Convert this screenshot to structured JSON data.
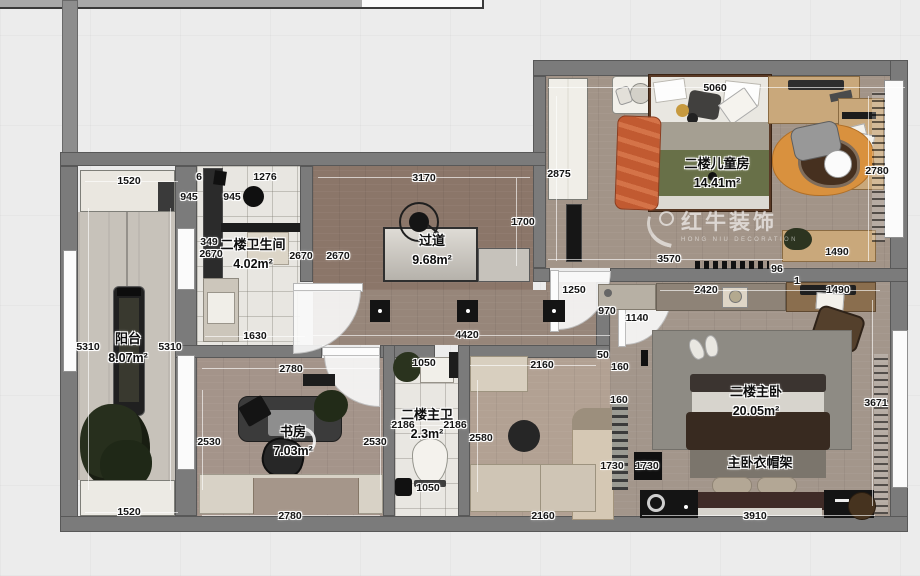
{
  "watermark": {
    "brand": "红牛装饰",
    "subtitle": "HONG NIU DECORATION"
  },
  "rooms": [
    {
      "name": "二楼儿童房",
      "area": "14.41m²",
      "x": 717,
      "y": 174
    },
    {
      "name": "过道",
      "area": "9.68m²",
      "x": 432,
      "y": 251
    },
    {
      "name": "二楼卫生间",
      "area": "4.02m²",
      "x": 253,
      "y": 255
    },
    {
      "name": "阳台",
      "area": "8.07m²",
      "x": 128,
      "y": 349
    },
    {
      "name": "书房",
      "area": "7.03m²",
      "x": 293,
      "y": 442
    },
    {
      "name": "二楼主卫",
      "area": "2.3m²",
      "x": 427,
      "y": 425
    },
    {
      "name": "二楼主卧",
      "area": "20.05m²",
      "x": 756,
      "y": 402
    },
    {
      "name": "主卧衣帽架",
      "area": "",
      "x": 760,
      "y": 463
    }
  ],
  "dimensions": [
    {
      "text": "5060",
      "x": 715,
      "y": 88
    },
    {
      "text": "2875",
      "x": 559,
      "y": 174
    },
    {
      "text": "2780",
      "x": 877,
      "y": 171
    },
    {
      "text": "3570",
      "x": 669,
      "y": 259
    },
    {
      "text": "96",
      "x": 777,
      "y": 269
    },
    {
      "text": "1490",
      "x": 837,
      "y": 252
    },
    {
      "text": "1",
      "x": 797,
      "y": 281
    },
    {
      "text": "2420",
      "x": 706,
      "y": 290
    },
    {
      "text": "1490",
      "x": 838,
      "y": 290
    },
    {
      "text": "1250",
      "x": 574,
      "y": 290
    },
    {
      "text": "970",
      "x": 607,
      "y": 311
    },
    {
      "text": "1140",
      "x": 637,
      "y": 318
    },
    {
      "text": "3170",
      "x": 424,
      "y": 178
    },
    {
      "text": "1700",
      "x": 523,
      "y": 222
    },
    {
      "text": "4420",
      "x": 467,
      "y": 335
    },
    {
      "text": "50",
      "x": 603,
      "y": 355
    },
    {
      "text": "160",
      "x": 620,
      "y": 367
    },
    {
      "text": "160",
      "x": 619,
      "y": 400
    },
    {
      "text": "1730",
      "x": 612,
      "y": 466
    },
    {
      "text": "1730",
      "x": 647,
      "y": 466
    },
    {
      "text": "3671",
      "x": 876,
      "y": 403
    },
    {
      "text": "3910",
      "x": 755,
      "y": 516
    },
    {
      "text": "1520",
      "x": 129,
      "y": 181
    },
    {
      "text": "6",
      "x": 199,
      "y": 177
    },
    {
      "text": "945",
      "x": 189,
      "y": 197
    },
    {
      "text": "945",
      "x": 232,
      "y": 197
    },
    {
      "text": "1276",
      "x": 265,
      "y": 177
    },
    {
      "text": "349",
      "x": 209,
      "y": 242
    },
    {
      "text": "2670",
      "x": 211,
      "y": 254
    },
    {
      "text": "2670",
      "x": 301,
      "y": 256
    },
    {
      "text": "2670",
      "x": 338,
      "y": 256
    },
    {
      "text": "1630",
      "x": 255,
      "y": 336
    },
    {
      "text": "5310",
      "x": 88,
      "y": 347
    },
    {
      "text": "5310",
      "x": 170,
      "y": 347
    },
    {
      "text": "1520",
      "x": 129,
      "y": 512
    },
    {
      "text": "2780",
      "x": 291,
      "y": 369
    },
    {
      "text": "2530",
      "x": 209,
      "y": 442
    },
    {
      "text": "2530",
      "x": 375,
      "y": 442
    },
    {
      "text": "2780",
      "x": 290,
      "y": 516
    },
    {
      "text": "1050",
      "x": 424,
      "y": 363
    },
    {
      "text": "2186",
      "x": 403,
      "y": 425
    },
    {
      "text": "2186",
      "x": 455,
      "y": 425
    },
    {
      "text": "2580",
      "x": 481,
      "y": 438
    },
    {
      "text": "1050",
      "x": 428,
      "y": 488
    },
    {
      "text": "2160",
      "x": 542,
      "y": 365
    },
    {
      "text": "2160",
      "x": 543,
      "y": 516
    }
  ],
  "colors": {
    "wall": "#7b7b7b",
    "background": "#ececec",
    "kids_floor": "#a29488",
    "hall_floor": "#8b7669",
    "tile": "#e8e6e1",
    "walnut_wood": "#c9a87b",
    "green_blanket": "#687048",
    "orange_rug": "#d9913e",
    "red_blanket": "#c15a31",
    "watermark_text": "rgba(255,255,255,0.6)"
  }
}
